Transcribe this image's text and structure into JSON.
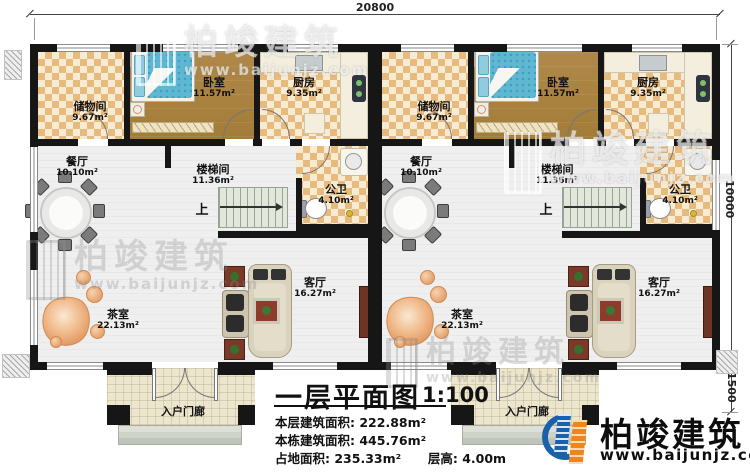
{
  "dimensions": {
    "top_width": "20800",
    "right_height": "10000",
    "porch_height": "1500"
  },
  "units": [
    {
      "storage_name": "储物间",
      "storage_area": "9.67m²",
      "bedroom_name": "卧室",
      "bedroom_area": "11.57m²",
      "kitchen_name": "厨房",
      "kitchen_area": "9.35m²",
      "dining_name": "餐厅",
      "dining_area": "10.10m²",
      "stair_name": "楼梯间",
      "stair_area": "11.36m²",
      "bath_name": "公卫",
      "bath_area": "4.10m²",
      "tea_name": "茶室",
      "tea_area": "22.13m²",
      "living_name": "客厅",
      "living_area": "16.27m²",
      "porch_name": "入户门廊",
      "stairs_up": "上"
    },
    {
      "storage_name": "储物间",
      "storage_area": "9.67m²",
      "bedroom_name": "卧室",
      "bedroom_area": "11.57m²",
      "kitchen_name": "厨房",
      "kitchen_area": "9.35m²",
      "dining_name": "餐厅",
      "dining_area": "10.10m²",
      "stair_name": "楼梯间",
      "stair_area": "11.36m²",
      "bath_name": "公卫",
      "bath_area": "4.10m²",
      "tea_name": "茶室",
      "tea_area": "22.13m²",
      "living_name": "客厅",
      "living_area": "16.27m²",
      "porch_name": "入户门廊",
      "stairs_up": "上"
    }
  ],
  "title_block": {
    "title": "一层平面图",
    "scale": "1:100",
    "rows": [
      {
        "label": "本层建筑面积:",
        "value": "222.88m²"
      },
      {
        "label": "本栋建筑面积:",
        "value": "445.76m²"
      },
      {
        "label": "占地面积:",
        "value": "235.33m²",
        "label2": "层高:",
        "value2": "4.00m"
      }
    ]
  },
  "logo": {
    "name": "柏竣建筑",
    "website": "www.baijunjz.com"
  },
  "watermark": {
    "name": "柏竣建筑",
    "website": "www.baijunjz.com"
  },
  "colors": {
    "wall": "#161616",
    "checker": "#e7ba7d",
    "wood": "#a98340",
    "brand_blue": "#1961ac",
    "brand_orange": "#f08519"
  }
}
